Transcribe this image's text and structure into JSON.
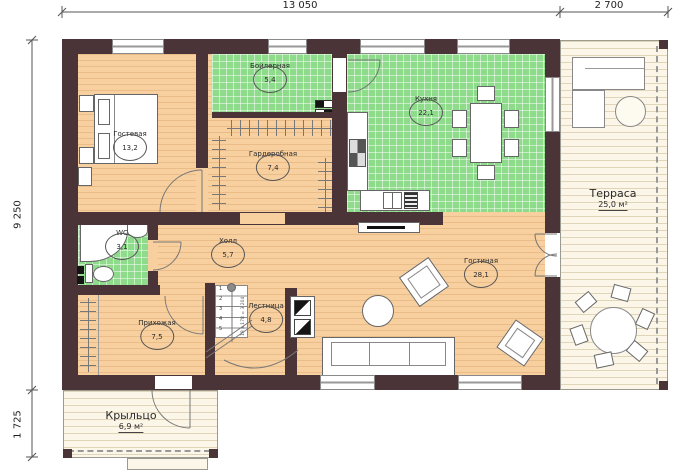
{
  "plan": {
    "dims": {
      "top_main": "13 050",
      "top_right": "2 700",
      "left_main": "9 250",
      "left_bottom": "1 725"
    },
    "rooms": {
      "guest": {
        "name": "Гостевая",
        "area": "13,2"
      },
      "boiler": {
        "name": "Бойлерная",
        "area": "5,4"
      },
      "kitchen": {
        "name": "Кухня",
        "area": "22,1"
      },
      "wardrobe": {
        "name": "Гардеробная",
        "area": "7,4"
      },
      "wc": {
        "name": "WC",
        "area": "3,1"
      },
      "hall": {
        "name": "Холл",
        "area": "5,7"
      },
      "hallway": {
        "name": "Прихожая",
        "area": "7,5"
      },
      "stairs": {
        "name": "Лестница",
        "area": "4,8"
      },
      "living": {
        "name": "Гостиная",
        "area": "28,1"
      },
      "terrace": {
        "name": "Терраса",
        "area": "25,0 м²"
      },
      "porch": {
        "name": "Крыльцо",
        "area": "6,9 м²"
      }
    },
    "stair_detail": {
      "steps": [
        "1",
        "2",
        "3",
        "4",
        "5"
      ],
      "note": "18 х 178 = 3 204"
    },
    "colors": {
      "wall": "#4b3438",
      "floor": "#f8cf9f",
      "tile": "#8edc8b",
      "deck": "#fbf6e7"
    }
  }
}
